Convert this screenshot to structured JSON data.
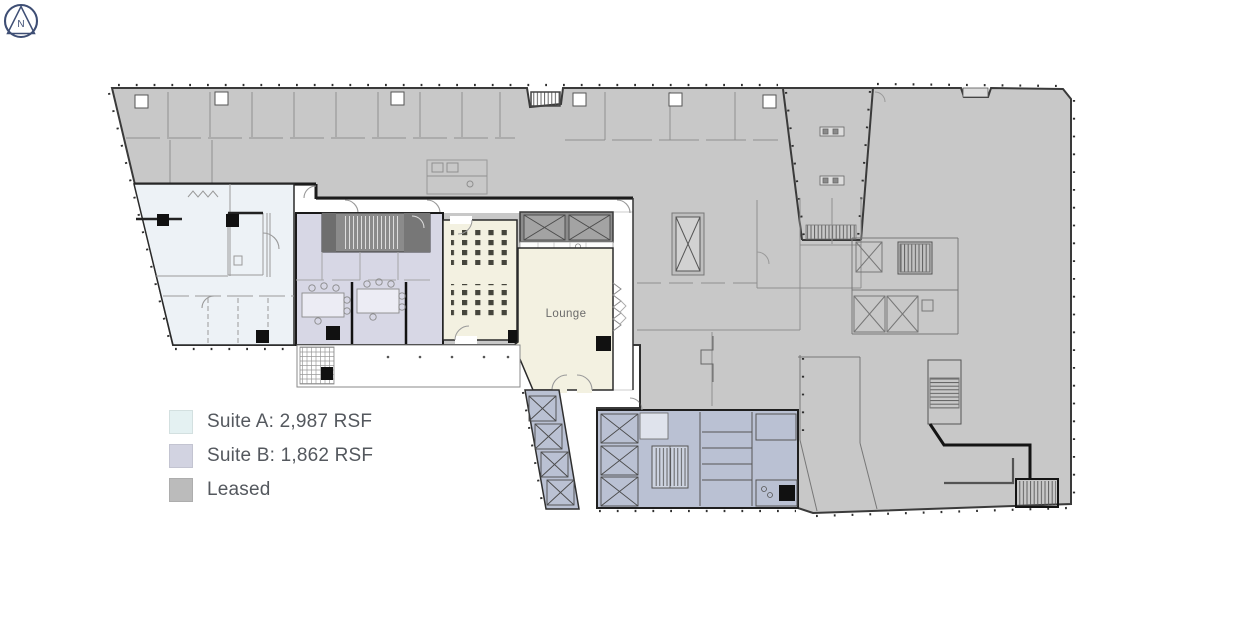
{
  "legend": {
    "items": [
      {
        "label": "Suite A: 2,987 RSF",
        "color": "#e4f1f2"
      },
      {
        "label": "Suite B: 1,862 RSF",
        "color": "#d2d3e1"
      },
      {
        "label": "Leased",
        "color": "#bbbbbb"
      }
    ]
  },
  "rooms": {
    "lounge_label": "Lounge"
  },
  "compass": {
    "letter": "N"
  },
  "colors": {
    "leased_fill": "#c8c8c8",
    "suite_a_fill": "#edf2f6",
    "suite_b_fill": "#d7d7e5",
    "cream_fill": "#f3f1e1",
    "core_fill": "#bac1d3",
    "dark_gray_fill": "#8b8b8b",
    "wall_color": "#3a3a3a",
    "compass_color": "#3e4e74"
  }
}
